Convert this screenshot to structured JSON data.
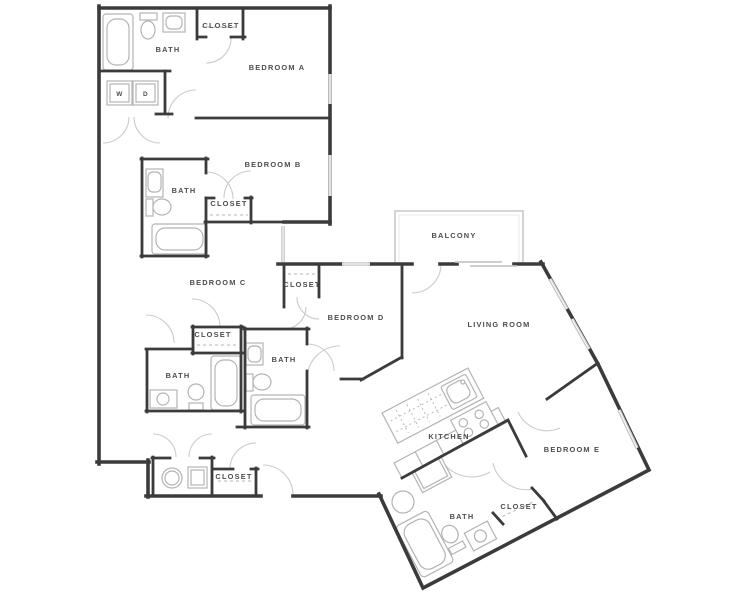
{
  "plan_type": "apartment-floor-plan",
  "colors": {
    "wall": "#3b3b3b",
    "fixture": "#b4b4b4",
    "door_arc": "#cbcbcb",
    "window": "#c6c6c6",
    "balcony": "#cfcfcf",
    "label": "#4d4d4d",
    "background": "#ffffff"
  },
  "labels": {
    "bath_a": "BATH",
    "closet_a": "CLOSET",
    "bedroom_a": "BEDROOM A",
    "washer": "W",
    "dryer": "D",
    "bedroom_b": "BEDROOM B",
    "bath_b": "BATH",
    "closet_b": "CLOSET",
    "bedroom_c": "BEDROOM C",
    "closet_c": "CLOSET",
    "closet_mid": "CLOSET",
    "bath_c": "BATH",
    "bath_d": "BATH",
    "bedroom_d": "BEDROOM D",
    "balcony": "BALCONY",
    "living_room": "LIVING ROOM",
    "kitchen": "KITCHEN",
    "bedroom_e": "BEDROOM E",
    "closet_e": "CLOSET",
    "bath_e": "BATH",
    "closet_entry": "CLOSET"
  }
}
